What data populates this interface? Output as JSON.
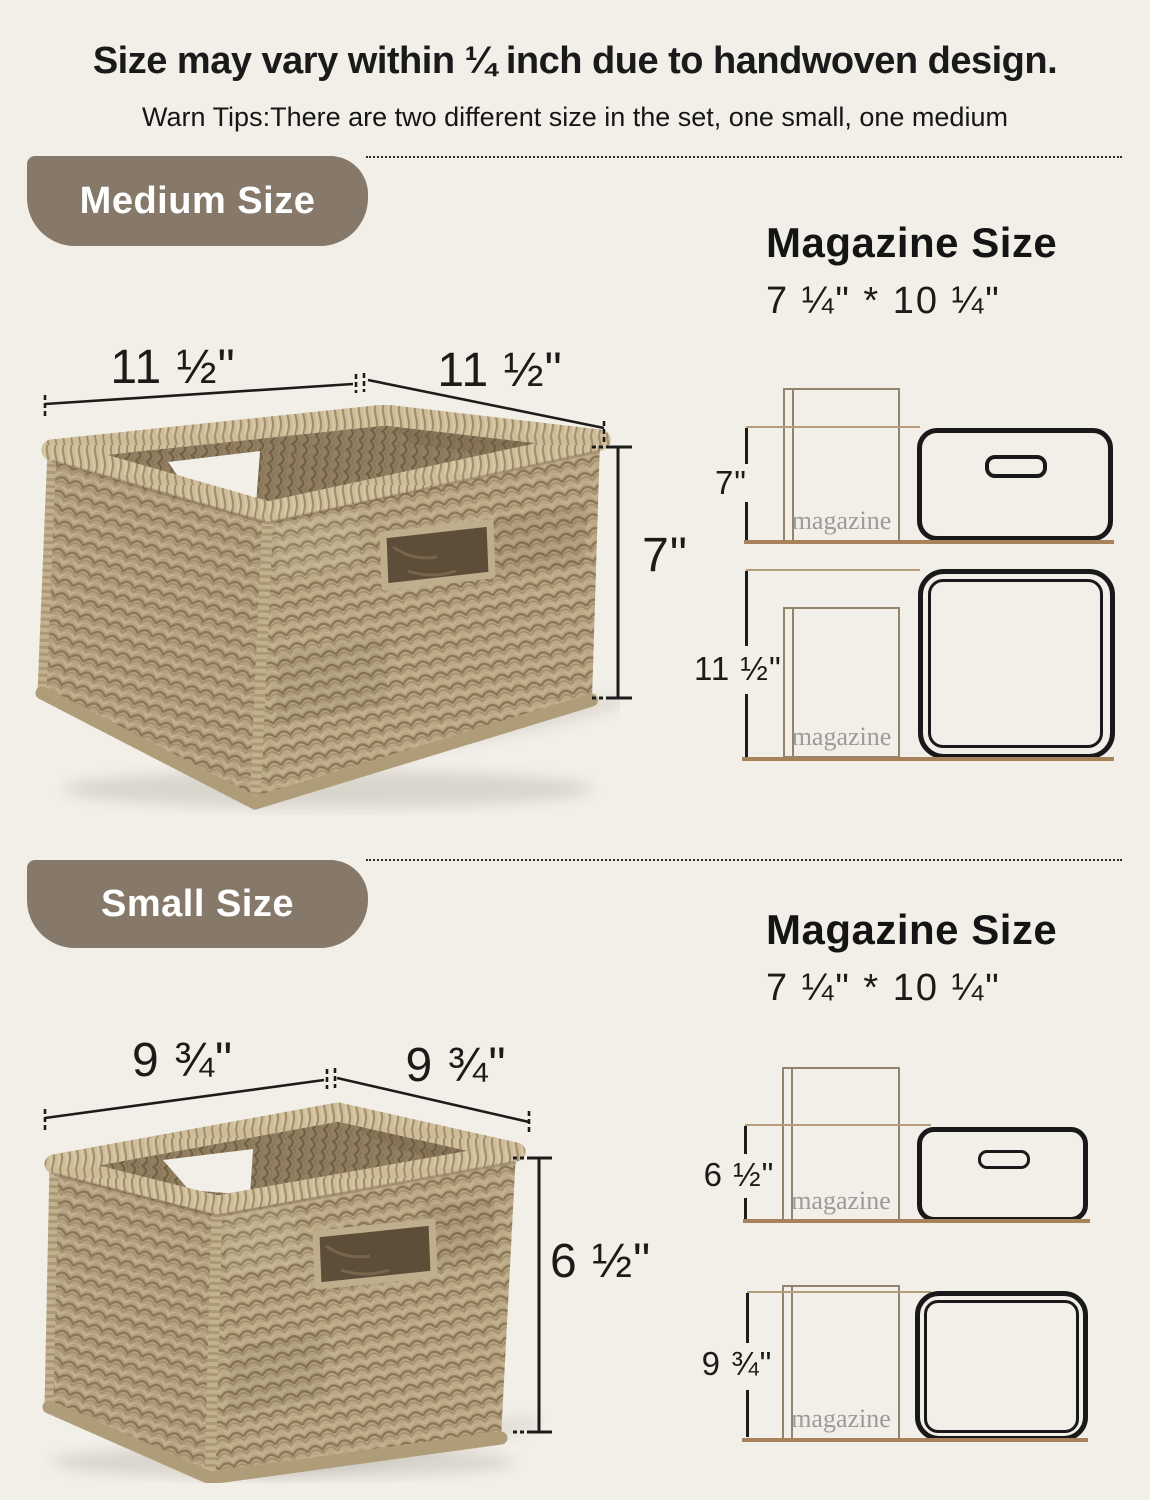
{
  "page": {
    "title": "Size may vary within ¼ inch due to handwoven design.",
    "subtitle": "Warn Tips:There are two different size in the set, one small, one medium"
  },
  "colors": {
    "background": "#f2efe8",
    "badge_bg": "#86796a",
    "badge_text": "#ffffff",
    "dimension_line": "#1e1c1a",
    "ground_line": "#a7825b",
    "basket_tan": "#b3a181",
    "magazine_text": "#9b9b9b"
  },
  "medium": {
    "badge": "Medium Size",
    "dim_left": "11 ½\"",
    "dim_right": "11 ½\"",
    "dim_height": "7\"",
    "panel": {
      "heading": "Magazine Size",
      "size": "7 ¼\" * 10 ¼\"",
      "side_dim": "7\"",
      "top_dim": "11 ½\"",
      "magazine_label": "magazine"
    }
  },
  "small": {
    "badge": "Small Size",
    "dim_left": "9 ¾\"",
    "dim_right": "9 ¾\"",
    "dim_height": "6 ½\"",
    "panel": {
      "heading": "Magazine Size",
      "size": "7 ¼\" * 10 ¼\"",
      "side_dim": "6 ½\"",
      "top_dim": "9 ¾\"",
      "magazine_label": "magazine"
    }
  }
}
